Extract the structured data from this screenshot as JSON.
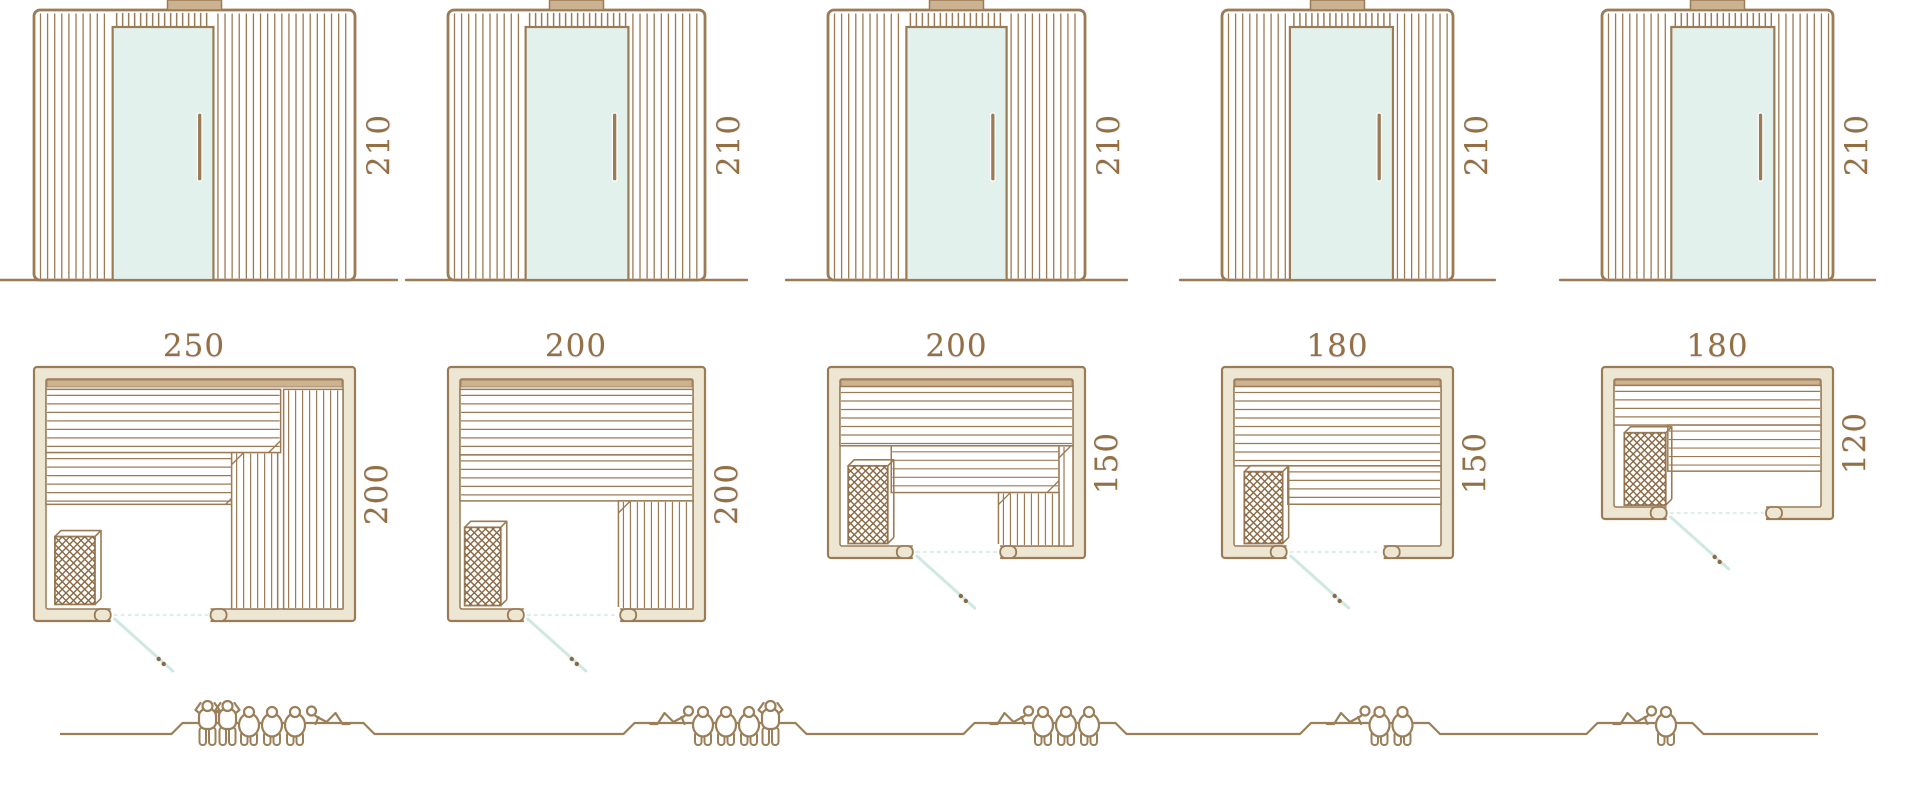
{
  "diagram": {
    "title": "Sauna cabin size comparison diagram",
    "colors": {
      "line": "#9b7b55",
      "line_dark": "#8a6a45",
      "dim_text": "#946f42",
      "wall_fill": "#ece6d3",
      "tan": "#cbb291",
      "glass": "#e3f1ed",
      "swing": "#cfe8e2",
      "swing_dot": "#dcefe9",
      "figure": "#9a7f58"
    },
    "models": [
      {
        "capacity": 6,
        "elevation": {
          "height_label": "210",
          "height_cm": 210,
          "door_x_frac": 0.245,
          "door_w_frac": 0.314
        },
        "plan": {
          "width_label": "250",
          "depth_label": "200",
          "width_cm": 250,
          "depth_cm": 200,
          "door_x1_frac": 0.239,
          "door_x2_frac": 0.55,
          "benches": [
            {
              "type": "hslat",
              "x": 0,
              "y": 0.045,
              "w": 0.79,
              "h": 0.275
            },
            {
              "type": "hslat",
              "x": 0,
              "y": 0.32,
              "w": 0.645,
              "h": 0.225
            },
            {
              "type": "vslat",
              "x": 0.625,
              "y": 0.32,
              "w": 0.155,
              "h": 0.68
            },
            {
              "type": "vslat",
              "x": 0.8,
              "y": 0.045,
              "w": 0.2,
              "h": 0.955
            },
            {
              "type": "heater",
              "x": 0.03,
              "y": 0.685,
              "w": 0.135,
              "h": 0.295
            }
          ]
        },
        "people": [
          "standing",
          "standing",
          "sitting",
          "sitting",
          "sitting",
          "lying-head-left"
        ]
      },
      {
        "capacity": 5,
        "elevation": {
          "height_label": "210",
          "height_cm": 210,
          "door_x_frac": 0.302,
          "door_w_frac": 0.4
        },
        "plan": {
          "width_label": "200",
          "depth_label": "200",
          "width_cm": 200,
          "depth_cm": 200,
          "door_x1_frac": 0.295,
          "door_x2_frac": 0.67,
          "benches": [
            {
              "type": "hslat",
              "x": 0,
              "y": 0.045,
              "w": 1.0,
              "h": 0.285
            },
            {
              "type": "hslat",
              "x": 0,
              "y": 0.33,
              "w": 1.0,
              "h": 0.2
            },
            {
              "type": "vslat",
              "x": 0.68,
              "y": 0.53,
              "w": 0.32,
              "h": 0.47
            },
            {
              "type": "heater",
              "x": 0.02,
              "y": 0.645,
              "w": 0.155,
              "h": 0.34
            }
          ]
        },
        "people": [
          "lying-head-right",
          "sitting",
          "sitting",
          "sitting",
          "standing"
        ]
      },
      {
        "capacity": 4,
        "elevation": {
          "height_label": "210",
          "height_cm": 210,
          "door_x_frac": 0.305,
          "door_w_frac": 0.39
        },
        "plan": {
          "width_label": "200",
          "depth_label": "150",
          "width_cm": 200,
          "depth_cm": 150,
          "door_x1_frac": 0.33,
          "door_x2_frac": 0.67,
          "benches": [
            {
              "type": "hslat",
              "x": 0,
              "y": 0.045,
              "w": 1.0,
              "h": 0.355
            },
            {
              "type": "hslat",
              "x": 0.22,
              "y": 0.4,
              "w": 0.72,
              "h": 0.28
            },
            {
              "type": "vslat",
              "x": 0.94,
              "y": 0.4,
              "w": 0.06,
              "h": 0.6
            },
            {
              "type": "vslat",
              "x": 0.68,
              "y": 0.68,
              "w": 0.26,
              "h": 0.32
            },
            {
              "type": "heater",
              "x": 0.035,
              "y": 0.52,
              "w": 0.17,
              "h": 0.465
            }
          ]
        },
        "people": [
          "lying-head-right",
          "sitting",
          "sitting",
          "sitting"
        ]
      },
      {
        "capacity": 3,
        "elevation": {
          "height_label": "210",
          "height_cm": 210,
          "door_x_frac": 0.294,
          "door_w_frac": 0.446
        },
        "plan": {
          "width_label": "180",
          "depth_label": "150",
          "width_cm": 180,
          "depth_cm": 150,
          "door_x1_frac": 0.28,
          "door_x2_frac": 0.7,
          "benches": [
            {
              "type": "hslat",
              "x": 0,
              "y": 0.045,
              "w": 1.0,
              "h": 0.475
            },
            {
              "type": "hslat",
              "x": 0.26,
              "y": 0.52,
              "w": 0.74,
              "h": 0.23
            },
            {
              "type": "heater",
              "x": 0.05,
              "y": 0.555,
              "w": 0.185,
              "h": 0.43
            }
          ]
        },
        "people": [
          "lying-head-right",
          "sitting",
          "sitting"
        ]
      },
      {
        "capacity": 2,
        "elevation": {
          "height_label": "210",
          "height_cm": 210,
          "door_x_frac": 0.3,
          "door_w_frac": 0.446
        },
        "plan": {
          "width_label": "180",
          "depth_label": "120",
          "width_cm": 180,
          "depth_cm": 120,
          "door_x1_frac": 0.28,
          "door_x2_frac": 0.71,
          "benches": [
            {
              "type": "hslat",
              "x": 0,
              "y": 0.05,
              "w": 1.0,
              "h": 0.31
            },
            {
              "type": "hslat",
              "x": 0.26,
              "y": 0.36,
              "w": 0.74,
              "h": 0.36
            },
            {
              "type": "heater",
              "x": 0.05,
              "y": 0.42,
              "w": 0.2,
              "h": 0.565
            }
          ]
        },
        "people": [
          "lying-head-right",
          "sitting"
        ]
      }
    ]
  }
}
